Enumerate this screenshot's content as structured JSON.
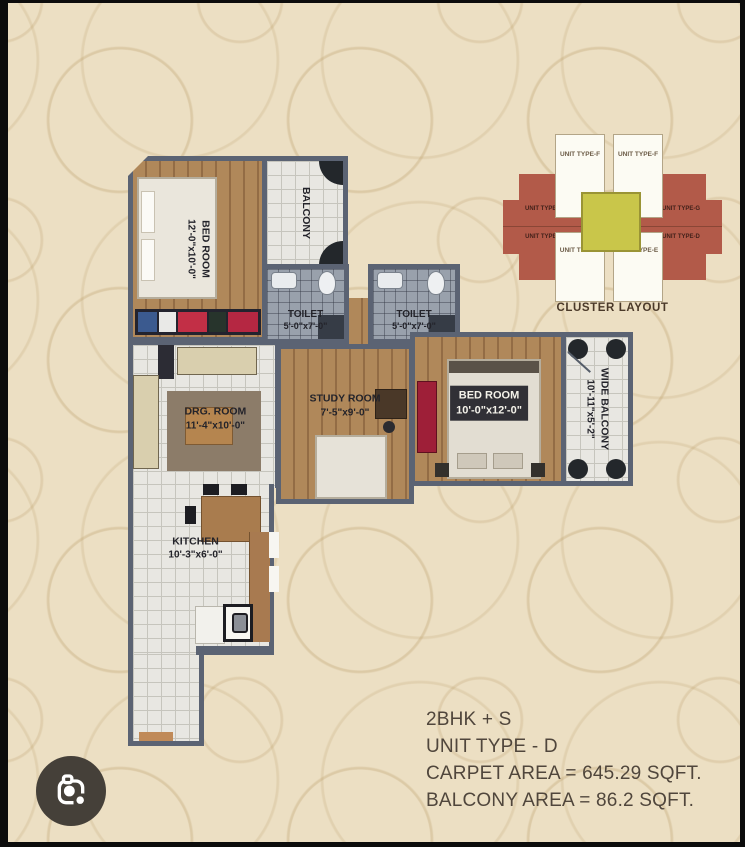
{
  "viewer": {
    "lens_button_icon": "google-lens-icon"
  },
  "floorplan": {
    "rooms": [
      {
        "id": "bedroom-1",
        "label": "BED ROOM",
        "dims": "12'-0\"x10'-0\""
      },
      {
        "id": "balcony",
        "label": "BALCONY",
        "dims": ""
      },
      {
        "id": "toilet-1",
        "label": "TOILET",
        "dims": "5'-0\"x7'-0\""
      },
      {
        "id": "toilet-2",
        "label": "TOILET",
        "dims": "5'-0\"x7'-0\""
      },
      {
        "id": "drawing-room",
        "label": "DRG. ROOM",
        "dims": "11'-4\"x10'-0\""
      },
      {
        "id": "study-room",
        "label": "STUDY ROOM",
        "dims": "7'-5\"x9'-0\""
      },
      {
        "id": "bedroom-2",
        "label": "BED ROOM",
        "dims": "10'-0\"x12'-0\""
      },
      {
        "id": "wide-balcony",
        "label": "WIDE BALCONY",
        "dims": "10'-11\"x5'-2\""
      },
      {
        "id": "kitchen",
        "label": "KITCHEN",
        "dims": "10'-3\"x6'-0\""
      }
    ]
  },
  "cluster": {
    "title": "CLUSTER LAYOUT",
    "units": {
      "top_left": "UNIT TYPE-F",
      "top_right": "UNIT TYPE-F",
      "left_upper": "UNIT TYPE-G",
      "left_lower": "UNIT TYPE-D",
      "right_upper": "UNIT TYPE-G",
      "right_lower": "UNIT TYPE-D",
      "bottom_left": "UNIT TYPE-E",
      "bottom_right": "UNIT TYPE-E"
    }
  },
  "info": {
    "lines": [
      "2BHK + S",
      "UNIT TYPE - D",
      "CARPET AREA = 645.29 SQFT.",
      "BALCONY AREA = 86.2 SQFT."
    ]
  },
  "colors": {
    "background": "#ecdfc3",
    "wall": "#5b6373",
    "wood_floor": "#b0885a",
    "tile_floor": "#e8e7e2",
    "toilet_floor": "#99a1ac",
    "cluster_red": "#b25a49",
    "cluster_center": "#c9c64a",
    "accent_red": "#c22f46",
    "text": "#50463c"
  }
}
